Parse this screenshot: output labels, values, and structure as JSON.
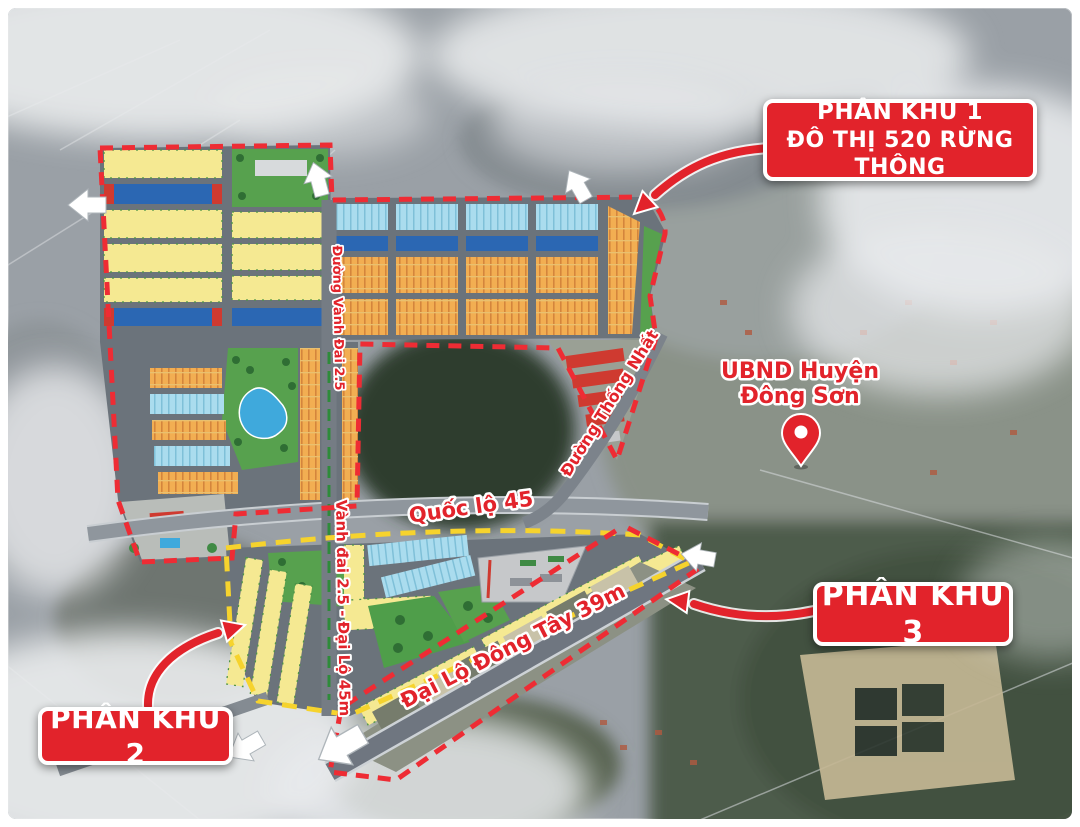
{
  "map_labels": {
    "phan_khu_1_line1": "PHÂN KHU 1",
    "phan_khu_1_line2": "ĐÔ THỊ 520 RỪNG THÔNG",
    "phan_khu_2": "PHÂN KHU 2",
    "phan_khu_3": "PHÂN KHU 3",
    "ubnd_line1": "UBND Huyện",
    "ubnd_line2": "Đông Sơn"
  },
  "road_labels": {
    "quoc_lo_45": "Quốc lộ 45",
    "dai_lo_dong_tay": "Đại Lộ Đông Tây 39m",
    "vanh_dai_dai_lo": "Vành đai 2.5 - Đại Lộ 45m",
    "duong_thong_nhat": "Đường Thống Nhất",
    "duong_vanh_dai": "Đường Vành Đai 2.5"
  },
  "icons": {
    "location_pin": "location-pin-icon",
    "direction_arrow": "direction-arrow-icon",
    "callout_arrow": "callout-arrow-icon"
  },
  "colors": {
    "callout_red": "#e2232b",
    "boundary_red": "#ee2c34",
    "boundary_yellow": "#f6d32d",
    "lot_yellow": "#f5e992",
    "lot_orange": "#f2ae52",
    "lot_cyan": "#aadcee",
    "shophouse_blue": "#2b67b3",
    "park_green": "#57a14e",
    "lake_blue": "#3fa9dc",
    "road_gray": "#6b737b",
    "cloud_white": "#e8eaec"
  }
}
